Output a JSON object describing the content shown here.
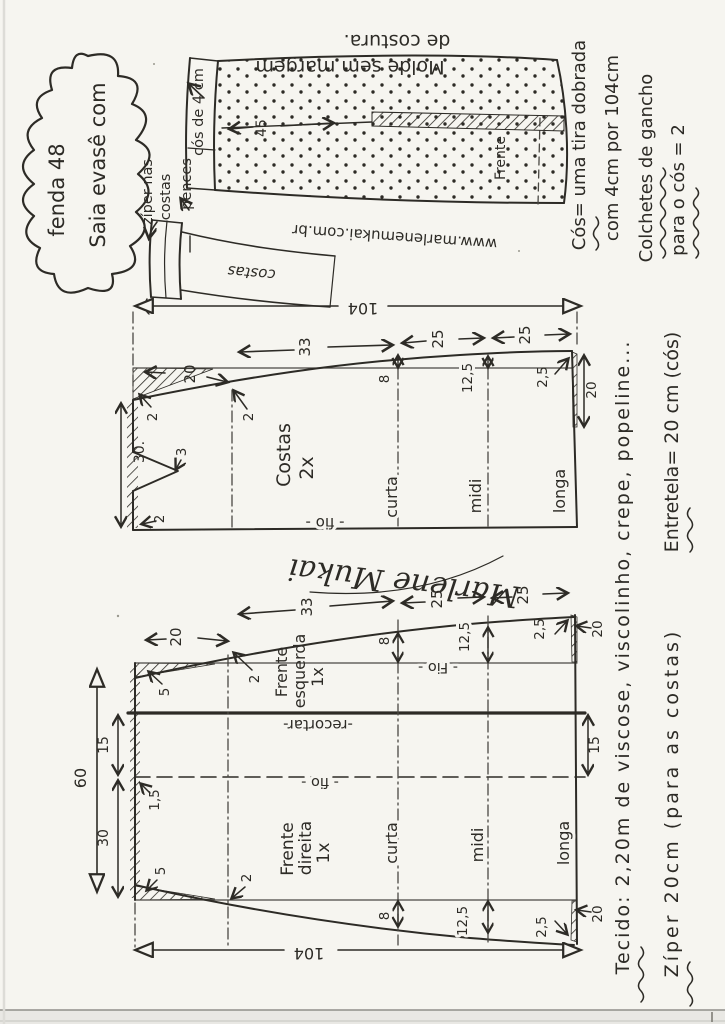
{
  "title": {
    "line1": "Saia evasê com",
    "line2": "fenda  48"
  },
  "sketch": {
    "molde1": "Molde sem margem",
    "molde2": "de costura.",
    "url": "www.marlenemukai.com.br",
    "cos": "cós de 4 cm",
    "ziper1": "zíper nas",
    "ziper2": "costas",
    "pences": "pences",
    "frente": "Frente",
    "costas": "costas",
    "d45": "45"
  },
  "notes": {
    "cos1": "Cós= uma tira dobrada",
    "cos2": "com 4cm por 104cm",
    "colchetes1": "Colchetes de gancho",
    "colchetes2": "para o cós = 2",
    "tecido": "Tecido: 2,20m de viscose, viscolinho, crepe, popeline...",
    "entretela": "Entretela= 20 cm (cós)",
    "ziper": "Zíper 20cm (para as costas)"
  },
  "signature": "Marlene Mukai",
  "costas": {
    "name": "Costas",
    "qty": "2x",
    "fio": "- fio -",
    "len": "104",
    "w": "30.",
    "s20": "20",
    "s33": "33",
    "s25a": "25",
    "s25b": "25",
    "d2a": "2",
    "d2b": "2",
    "d3": "3",
    "d2c": "2",
    "d8": "8",
    "d125": "12,5",
    "d25": "2,5",
    "slit": "20",
    "curta": "curta",
    "midi": "midi",
    "longa": "longa"
  },
  "frente": {
    "esq1": "Frente",
    "esq2": "esquerda",
    "esq3": "1x",
    "dir1": "Frente",
    "dir2": "direita",
    "dir3": "1x",
    "recortar": "-recortar-",
    "fioTop": "- Fio -",
    "fioBot": "- fio -",
    "len": "104",
    "w60": "60",
    "w30": "30",
    "w15l": "15",
    "w15r": "15",
    "d15": "1,5",
    "s20": "20",
    "s33": "33",
    "s25a": "25",
    "s25b": "25",
    "d5a": "5",
    "d5b": "5",
    "d2a": "2",
    "d2b": "2",
    "d8a": "8",
    "d125a": "12,5",
    "d25a": "2,5",
    "d8b": "8",
    "d125b": "12,5",
    "d25b": "2,5",
    "slitTop": "20",
    "slitBot": "20",
    "curta": "curta",
    "midi": "midi",
    "longa": "longa"
  }
}
